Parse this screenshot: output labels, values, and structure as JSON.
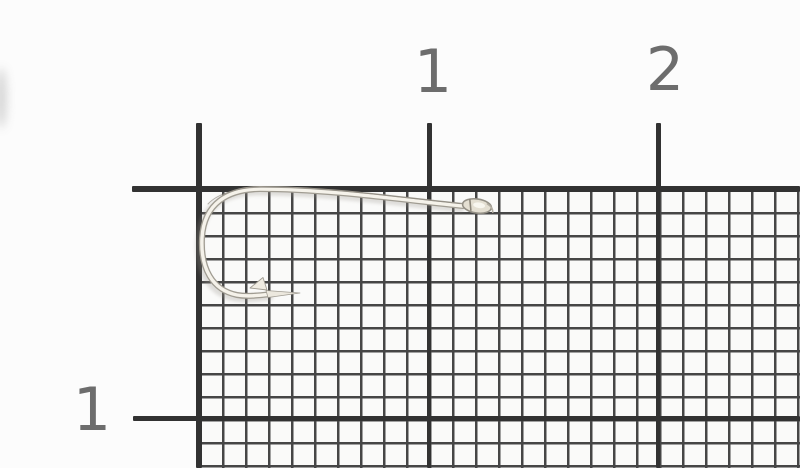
{
  "meta": {
    "description": "Photograph of a single silver/nickel fishing hook lying on black millimeter graph paper with centimeter ruler markings"
  },
  "ruler": {
    "unit": "cm",
    "top_labels": [
      {
        "text": "1"
      },
      {
        "text": "2"
      }
    ],
    "side_labels": [
      {
        "text": "1"
      }
    ]
  },
  "objects": {
    "hook": {
      "kind": "fishing hook",
      "finish": "silver",
      "parts": [
        "eye",
        "shank",
        "bend",
        "barb",
        "point"
      ]
    }
  },
  "colors": {
    "paper": "#fcfcfc",
    "grid_fine_line": "#464646",
    "grid_bold_line": "#323232",
    "ruler_label_text": "#6d6d6d",
    "hook_body": "#f5f2ea",
    "hook_edge": "#a09c92"
  }
}
